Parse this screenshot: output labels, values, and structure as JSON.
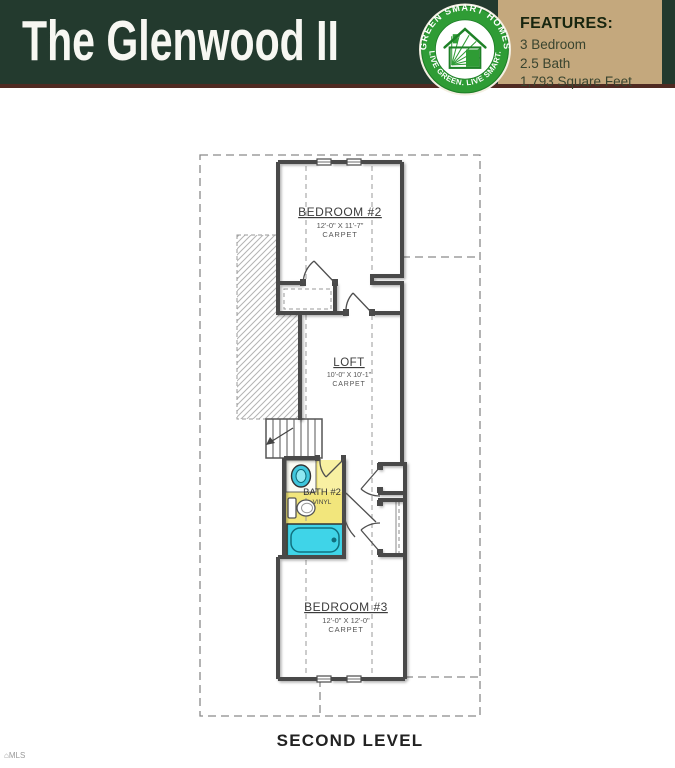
{
  "header": {
    "title": "The Glenwood II",
    "features": {
      "heading": "FEATURES:",
      "items": [
        "3 Bedroom",
        "2.5 Bath",
        "1,793 Square Feet"
      ]
    },
    "logo": {
      "arc_top": "GREEN SMART HOMES",
      "arc_bottom": "LIVE GREEN. LIVE SMART.",
      "icon": "green-house-icon"
    },
    "colors": {
      "bar_green": "#233a2e",
      "features_tan": "#c4a87d",
      "bottom_maroon": "#4f2a22",
      "logo_green": "#2f9c35"
    }
  },
  "floorplan": {
    "level_label": "SECOND LEVEL",
    "rooms": {
      "bedroom2": {
        "name": "BEDROOM #2",
        "dims": "12'-0\" X 11'-7\"",
        "floor": "CARPET"
      },
      "loft": {
        "name": "LOFT",
        "dims": "10'-0\" X 10'-1\"",
        "floor": "CARPET"
      },
      "bath2": {
        "name": "BATH #2",
        "floor": "VINYL"
      },
      "bedroom3": {
        "name": "BEDROOM #3",
        "dims": "12'-0\" X 12'-0\"",
        "floor": "CARPET"
      }
    },
    "colors": {
      "bath_floor": "#f2e67c",
      "tub": "#3fd4e8",
      "walls": "#4a4a4a"
    }
  },
  "watermark": {
    "text": "MLS"
  }
}
